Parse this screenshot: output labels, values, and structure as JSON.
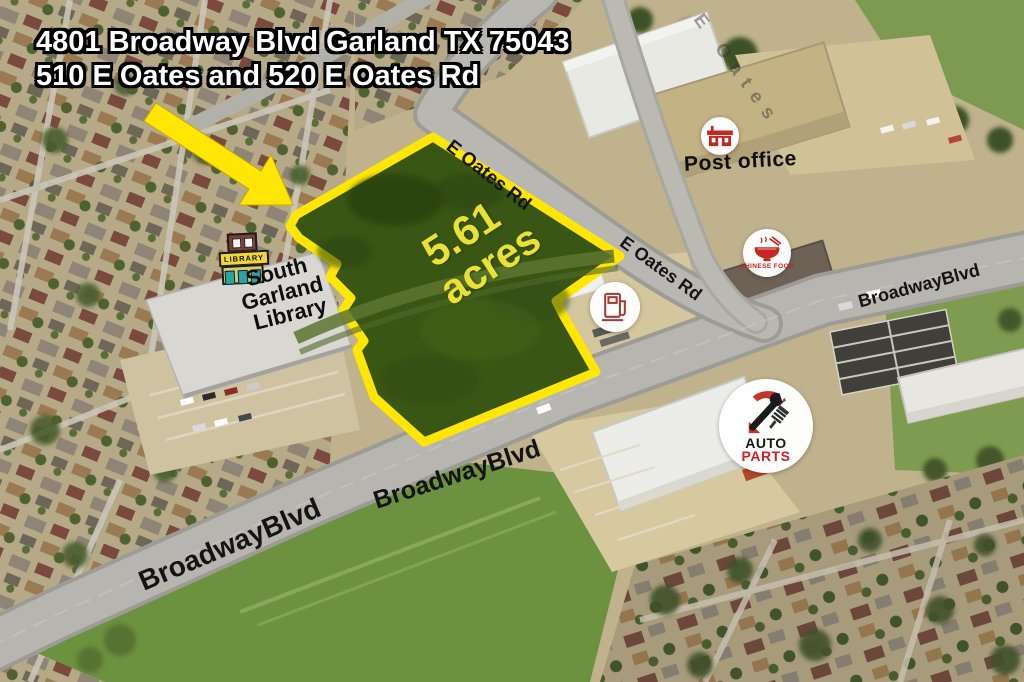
{
  "map": {
    "title": {
      "line1": "4801 Broadway Blvd Garland TX 75043",
      "line2": "510 E Oates and 520 E Oates Rd"
    },
    "parcel": {
      "area": "5.61",
      "unit": "acres"
    },
    "road_labels": [
      {
        "id": "e-oates-top",
        "text": "E Oates Rd"
      },
      {
        "id": "e-oates-east",
        "text": "E Oates Rd"
      },
      {
        "id": "broadway-northeast",
        "text": "BroadwayBlvd"
      },
      {
        "id": "broadway-center",
        "text": "BroadwayBlvd"
      },
      {
        "id": "broadway-southwest",
        "text": "BroadwayBlvd"
      },
      {
        "id": "e-oates-ghost",
        "text": "E Oates"
      }
    ],
    "pois": {
      "post_office": {
        "label": "Post office",
        "icon": "post-office-building-icon"
      },
      "chinese_food": {
        "label": "CHINESE FOOD",
        "icon": "noodle-bowl-icon"
      },
      "gas_station": {
        "icon": "gas-pump-icon"
      },
      "auto_parts": {
        "label_line1": "AUTO",
        "label_line2": "PARTS",
        "icon": "wrench-shock-icon"
      },
      "library": {
        "sign_text": "LIBRARY",
        "name_line1": "South",
        "name_line2": "Garland",
        "name_line3": "Library",
        "icon": "library-building-icon"
      }
    },
    "colors": {
      "parcel_outline": "#ffe604",
      "parcel_fill": "#3a5614",
      "acreage_text": "#e9e135",
      "road_label_text": "#141414",
      "title_fill": "#ffffff",
      "title_outline": "#000000",
      "poi_accent_red": "#c5261f"
    }
  }
}
